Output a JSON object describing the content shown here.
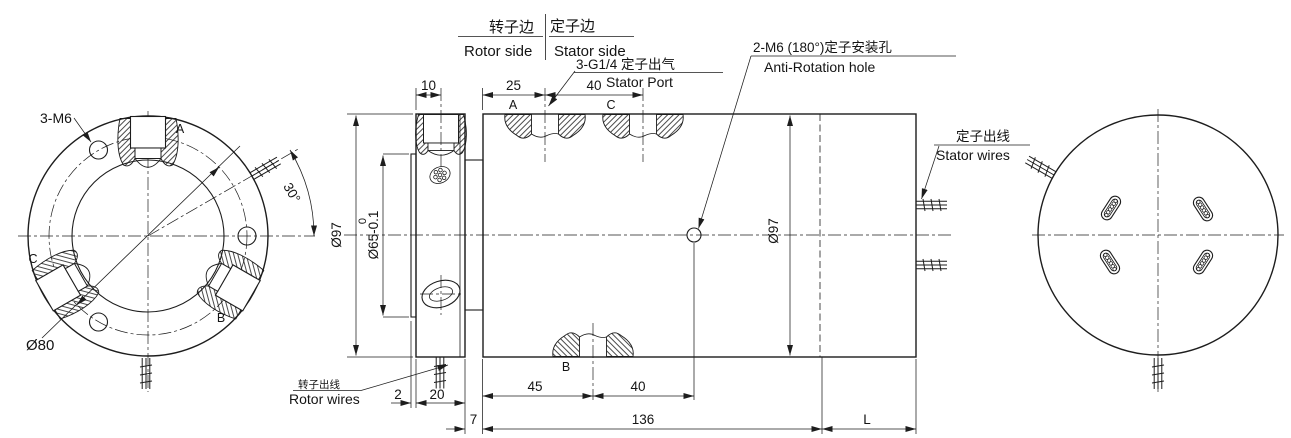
{
  "colors": {
    "line": "#1d1d1d",
    "background": "#ffffff"
  },
  "header": {
    "rotor_side_cn": "转子边",
    "rotor_side_en": "Rotor side",
    "stator_side_cn": "定子边",
    "stator_side_en": "Stator side"
  },
  "callouts": {
    "stator_port_cn": "3-G1/4 定子出气",
    "stator_port_en": "Stator Port",
    "anti_rotation_cn": "2-M6 (180°)定子安装孔",
    "anti_rotation_en": "Anti-Rotation hole",
    "stator_wires_cn": "定子出线",
    "stator_wires_en": "Stator wires",
    "rotor_wires_cn": "转子出线",
    "rotor_wires_en": "Rotor wires",
    "bolt_holes": "3-M6",
    "bolt_circle_dia": "Ø80",
    "wire_exit_angle": "30°"
  },
  "port_labels": {
    "left_a": "A",
    "left_b": "B",
    "left_c": "C",
    "top_a": "A",
    "top_c": "C",
    "bottom_b": "B"
  },
  "dimensions": {
    "rotor_port_offset": "10",
    "port_a_offset": "25",
    "top_port_spacing": "40",
    "flange_od": "Ø97",
    "bore_tol_upper": "0",
    "bore_dia": "Ø65-0.1",
    "back_plate_thickness": "2",
    "flange_thickness": "20",
    "spacer_width": "7",
    "port_b_offset": "45",
    "bottom_port_spacing": "40",
    "body_length": "136",
    "extension_length": "L",
    "body_od": "Ø97"
  }
}
